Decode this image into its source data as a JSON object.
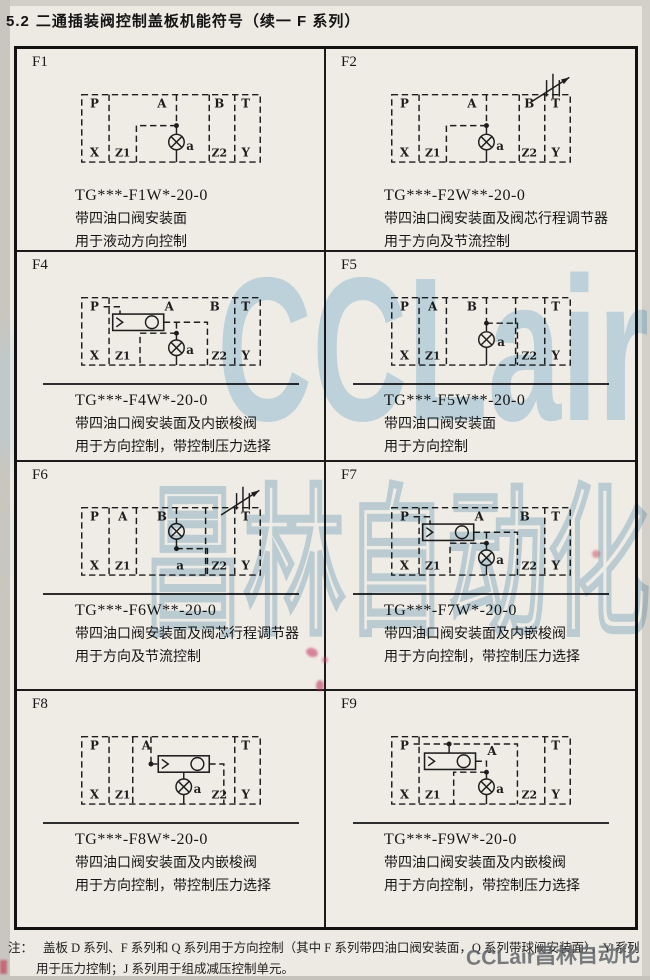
{
  "page": {
    "section_number": "5.2",
    "title": "二通插装阀控制盖板机能符号（续一  F 系列）",
    "note_label": "注：",
    "note_line1": "盖板 D 系列、F 系列和 Q 系列用于方向控制（其中 F 系列带四油口阀安装面，Q 系列带球阀安装面），Y 系列",
    "note_line2": "用于压力控制；J 系列用于组成减压控制单元。",
    "watermark_latin": "CCLair",
    "watermark_cjk": "昌林自动化",
    "watermark_small": "CCLair昌林自动化"
  },
  "cells": [
    {
      "id": "F1",
      "model": "TG***-F1W*-20-0",
      "desc": [
        "带四油口阀安装面",
        "用于液动方向控制"
      ],
      "schematic": {
        "type": "f1",
        "adjuster": false,
        "shuttle": false,
        "top_ports": [
          "P",
          "A",
          "B",
          "T"
        ],
        "bottom_ports": [
          "X",
          "Z1",
          "a",
          "Z2",
          "Y"
        ]
      }
    },
    {
      "id": "F2",
      "model": "TG***-F2W**-20-0",
      "desc": [
        "带四油口阀安装面及阀芯行程调节器",
        "用于方向及节流控制"
      ],
      "schematic": {
        "type": "f1",
        "adjuster": true,
        "shuttle": false,
        "top_ports": [
          "P",
          "A",
          "B",
          "T"
        ],
        "bottom_ports": [
          "X",
          "Z1",
          "a",
          "Z2",
          "Y"
        ]
      }
    },
    {
      "id": "F4",
      "model": "TG***-F4W*-20-0",
      "desc": [
        "带四油口阀安装面及内嵌梭阀",
        "用于方向控制，带控制压力选择"
      ],
      "schematic": {
        "type": "f4",
        "adjuster": false,
        "shuttle": true,
        "top_ports": [
          "P",
          "A",
          "B",
          "T"
        ],
        "bottom_ports": [
          "X",
          "Z1",
          "a",
          "Z2",
          "Y"
        ]
      }
    },
    {
      "id": "F5",
      "model": "TG***-F5W**-20-0",
      "desc": [
        "带四油口阀安装面",
        "用于方向控制"
      ],
      "schematic": {
        "type": "f5",
        "adjuster": false,
        "shuttle": false,
        "top_ports": [
          "P",
          "A",
          "B",
          "T"
        ],
        "bottom_ports": [
          "X",
          "Z1",
          "a",
          "Z2",
          "Y"
        ]
      }
    },
    {
      "id": "F6",
      "model": "TG***-F6W**-20-0",
      "desc": [
        "带四油口阀安装面及阀芯行程调节器",
        "用于方向及节流控制"
      ],
      "schematic": {
        "type": "f6",
        "adjuster": true,
        "shuttle": false,
        "top_ports": [
          "P",
          "A",
          "B",
          "T"
        ],
        "bottom_ports": [
          "X",
          "Z1",
          "a",
          "Z2",
          "Y"
        ]
      }
    },
    {
      "id": "F7",
      "model": "TG***-F7W*-20-0",
      "desc": [
        "带四油口阀安装面及内嵌梭阀",
        "用于方向控制，带控制压力选择"
      ],
      "schematic": {
        "type": "f4",
        "adjuster": false,
        "shuttle": true,
        "top_ports": [
          "P",
          "A",
          "B",
          "T"
        ],
        "bottom_ports": [
          "X",
          "Z1",
          "a",
          "Z2",
          "Y"
        ]
      }
    },
    {
      "id": "F8",
      "model": "TG***-F8W*-20-0",
      "desc": [
        "带四油口阀安装面及内嵌梭阀",
        "用于方向控制，带控制压力选择"
      ],
      "schematic": {
        "type": "f8",
        "adjuster": false,
        "shuttle": true,
        "top_ports": [
          "P",
          "A",
          "T"
        ],
        "bottom_ports": [
          "X",
          "Z1",
          "a",
          "Z2",
          "Y"
        ]
      }
    },
    {
      "id": "F9",
      "model": "TG***-F9W*-20-0",
      "desc": [
        "带四油口阀安装面及内嵌梭阀",
        "用于方向控制，带控制压力选择"
      ],
      "schematic": {
        "type": "f9",
        "adjuster": false,
        "shuttle": true,
        "top_ports": [
          "P",
          "A",
          "T"
        ],
        "bottom_ports": [
          "X",
          "Z1",
          "a",
          "Z2",
          "Y"
        ]
      }
    }
  ]
}
